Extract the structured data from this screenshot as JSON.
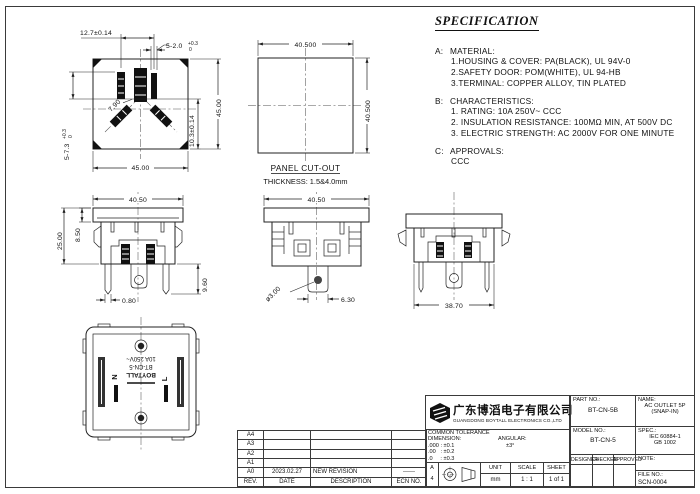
{
  "specification": {
    "title": "SPECIFICATION",
    "a_label": "A:",
    "a_heading": "MATERIAL:",
    "a_items": [
      "1.HOUSING & COVER: PA(BLACK), UL 94V-0",
      "2.SAFETY DOOR: POM(WHITE), UL 94-HB",
      "3.TERMINAL: COPPER ALLOY, TIN PLATED"
    ],
    "b_label": "B:",
    "b_heading": "CHARACTERISTICS:",
    "b_items": [
      "1. RATING: 10A 250V~ CCC",
      "2. INSULATION RESISTANCE: 100MΩ MIN, AT 500V DC",
      "3. ELECTRIC STRENGTH: AC 2000V FOR ONE MINUTE"
    ],
    "c_label": "C:",
    "c_heading": "APPROVALS:",
    "c_items": [
      "CCC"
    ]
  },
  "drawings": {
    "front": {
      "dim_pin_pitch": "12.7±0.14",
      "dim_slot_width": "5-2.0",
      "dim_slot_width_tol_up": "+0.3",
      "dim_slot_width_tol_dn": "0",
      "dim_slot_height": "5-7.3",
      "dim_slot_height_tol_up": "+0.3",
      "dim_slot_height_tol_dn": "0",
      "dim_height": "45.00",
      "dim_slot_offset": "10.3±0.14",
      "dim_width": "45.00",
      "dim_angle": "7.90"
    },
    "panel_cutout": {
      "dim_width": "40.500",
      "dim_height": "40.500",
      "label": "PANEL CUT-OUT",
      "thickness": "THICKNESS: 1.5&4.0mm"
    },
    "side_front": {
      "dim_width": "40.50",
      "dim_bezel": "8.50",
      "dim_height": "25.00",
      "dim_terminal": "9.60",
      "dim_pin": "0.80"
    },
    "side_right": {
      "dim_width": "40.50",
      "dim_hole": "ø3.00",
      "dim_tab": "6.30"
    },
    "side_back": {
      "dim_width": "38.70"
    },
    "back": {
      "brand": "BOYTALL",
      "model": "BT-CN-5",
      "rating": "10A 250V~",
      "neutral": "N",
      "live": "L"
    }
  },
  "revision_table": {
    "headers": [
      "REV.",
      "DATE",
      "DESCRIPTION",
      "ECN NO."
    ],
    "rows": [
      {
        "rev": "A4",
        "date": "",
        "desc": "",
        "ecn": ""
      },
      {
        "rev": "A3",
        "date": "",
        "desc": "",
        "ecn": ""
      },
      {
        "rev": "A2",
        "date": "",
        "desc": "",
        "ecn": ""
      },
      {
        "rev": "A1",
        "date": "",
        "desc": "",
        "ecn": ""
      },
      {
        "rev": "A0",
        "date": "2023.02.27",
        "desc": "NEW REVISION",
        "ecn": "------"
      }
    ]
  },
  "title_block": {
    "company_cn": "广东博滔电子有限公司",
    "company_en": "GUANGDONG BOYTALL ELECTRONICS CO.,LTD",
    "part_no_label": "PART NO.:",
    "part_no": "BT-CN-5B",
    "name_label": "NAME:",
    "name_line1": "AC OUTLET 5P",
    "name_line2": "(SNAP-IN)",
    "model_no_label": "MODEL NO.:",
    "model_no": "BT-CN-5",
    "spec_label": "SPEC.:",
    "spec_line1": "IEC 60884-1",
    "spec_line2": "GB 1002",
    "designer_label": "DESIGNER",
    "checked_label": "CHECKED",
    "approved_label": "APPROVED",
    "note_label": "NOTE:",
    "file_no_label": "FILE NO.:",
    "file_no": "SCN-0004",
    "tolerance_title": "COMMON TOLERANCE",
    "dimension_label": "DIMENSION:",
    "angular_label": "ANGULAR:",
    "angular_value": "±3°",
    "tol_rows": [
      ".000 : ±0.1",
      ".00   : ±0.2",
      ".0     : ±0.3"
    ],
    "paper_top": "A",
    "paper_bottom": "4",
    "unit_label": "UNIT",
    "unit_value": "mm",
    "scale_label": "SCALE",
    "scale_value": "1 : 1",
    "sheet_label": "SHEET",
    "sheet_value": "1 of 1"
  }
}
